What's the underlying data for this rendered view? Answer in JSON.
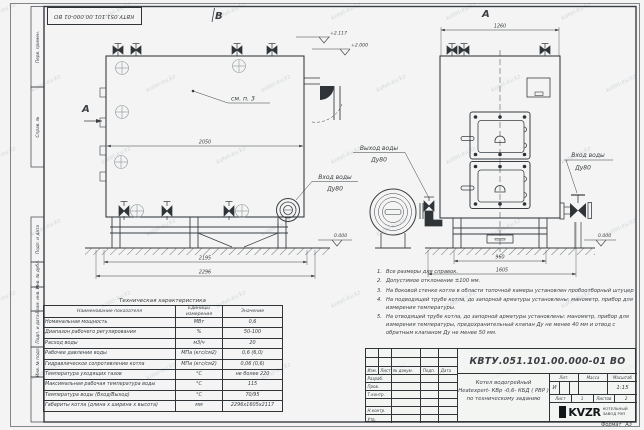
{
  "sheet": {
    "stamp_top": "КВТУ.051.101.00.000-01 ВО",
    "watermark": "kotel-kv.kz",
    "format_label": "Формат",
    "format_value": "А3",
    "margin_labels": [
      "Перв. примен.",
      "Справ. №",
      "Подп. и дата",
      "Инв. № дубл.",
      "Взам. инв. №",
      "Подп. и дата",
      "Инв. № подл."
    ]
  },
  "views": {
    "left_view_letter": "В",
    "right_view_letter": "А",
    "section_letter": "А",
    "callout_see_item": "см. п. 3",
    "water_outlet_line1": "Выход воды",
    "water_outlet_line2": "Ду80",
    "water_inlet_left_line1": "Вход воды",
    "water_inlet_left_line2": "Ду80",
    "water_inlet_right_line1": "Вход воды",
    "water_inlet_right_line2": "Ду80",
    "elevation_top": "+2.117",
    "elevation_mid": "+2.000",
    "elevation_zero_left": "0.000",
    "elevation_zero_right": "0.000",
    "dim_body_length": "2050",
    "dim_base_inner": "2195",
    "dim_base_outer": "2296",
    "dim_front_width": "1260",
    "dim_front_base_inner": "960",
    "dim_front_base_outer": "1605"
  },
  "notes": {
    "items": [
      {
        "num": "1.",
        "text": "Все размеры для справок."
      },
      {
        "num": "2.",
        "text": "Допустимое отклонение  ±100 мм."
      },
      {
        "num": "3.",
        "text": "На боковой стенке котла в области топочной камеры установлен пробоотборный штуцер"
      },
      {
        "num": "4.",
        "text": "На подводящей трубе котла, до запорной арматуры установлены: манометр, прибор для измерения температуры."
      },
      {
        "num": "5.",
        "text": "На отводящей трубе котла, до запорной арматуры установлены: манометр, прибор для измерения температуры, предохранительный клапан Ду не менее 40 мм и отвод с обратным клапаном Ду не менее 50 мм."
      }
    ]
  },
  "tech_table": {
    "title": "Техническая характеристика",
    "headers": [
      "Наименование показателя",
      "Единицы измерения",
      "Значение"
    ],
    "rows": [
      [
        "Номинальная мощность",
        "МВт",
        "0,6"
      ],
      [
        "Диапазон рабочего регулирования",
        "%",
        "50-100"
      ],
      [
        "Расход воды",
        "м3/ч",
        "20"
      ],
      [
        "Рабочее давление воды",
        "МПа (кгс/см2)",
        "0,6 (6,0)"
      ],
      [
        "Гидравлическое сопротивление котла",
        "МПа (кгс/см2)",
        "0,06 (0,6)"
      ],
      [
        "Температура уходящих газов",
        "°С",
        "не более 220"
      ],
      [
        "Максимальная рабочая температура воды",
        "°С",
        "115"
      ],
      [
        "Температура воды (Вход/Выход)",
        "°С",
        "70/95"
      ],
      [
        "Габариты котла (длина х ширина х высота)",
        "мм",
        "2296х1605х2117"
      ]
    ]
  },
  "title_block": {
    "doc_number": "КВТУ.051.101.00.000-01 ВО",
    "title_line1": "Котел водогрейный",
    "title_line2": "Heatexpert- КВр -0,6- КБД ( РВР )",
    "title_line3": "по техническому заданию",
    "col_headers": [
      "Изм.",
      "Лист",
      "№ докум.",
      "Подп.",
      "Дата"
    ],
    "row_labels": [
      "Разраб.",
      "Пров.",
      "Т.контр.",
      "",
      "Н.контр.",
      "Утв."
    ],
    "lit_label": "Лит.",
    "lit_value": "И",
    "mass_label": "Масса",
    "scale_label": "Масштаб",
    "scale_value": "1:15",
    "sheet_label": "Лист",
    "sheet_value": "1",
    "sheets_label": "Листов",
    "sheets_value": "2",
    "logo_text": "KVZR",
    "logo_sub1": "КОТЕЛЬНЫЙ",
    "logo_sub2": "ЗАВОД РЭП"
  }
}
